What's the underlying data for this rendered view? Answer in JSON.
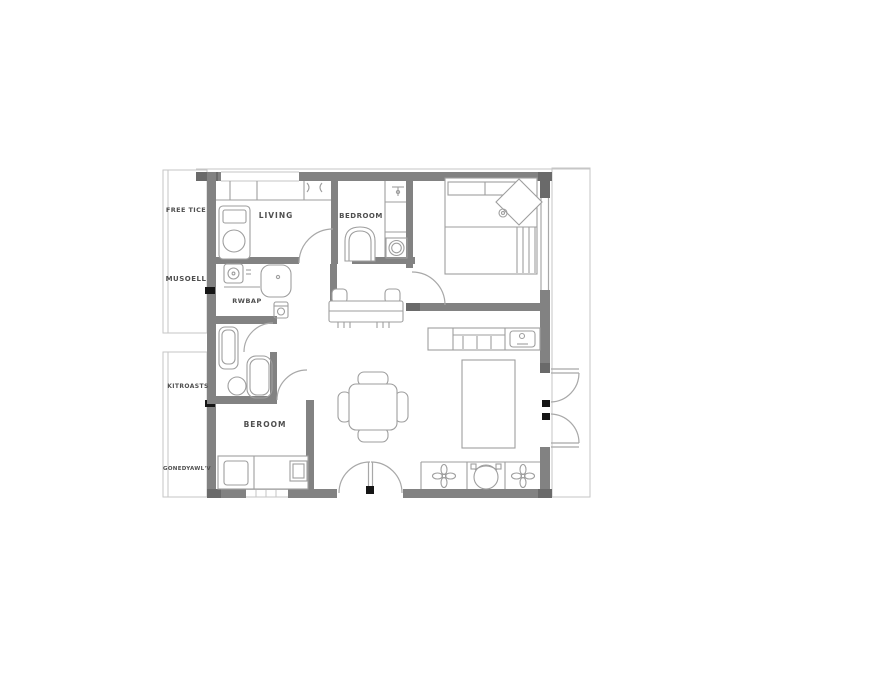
{
  "plan": {
    "colors": {
      "wall": "#828282",
      "wall_dark": "#6a6a6a",
      "line": "#a8a8a8",
      "furniture": "#9e9e9e",
      "label": "#4f4f4f",
      "accent_black": "#151515",
      "background": "#ffffff"
    },
    "rooms": {
      "living": {
        "label": "LIVING"
      },
      "bath_top": {
        "label": "BEDROOM"
      },
      "kitchen_laundry": {
        "label": "RWBAP"
      },
      "bedroom_bottom": {
        "label": "BEROOM"
      }
    },
    "side_labels": {
      "top_left_1": "FREE TICE",
      "top_left_2": "MUSOELL",
      "bottom_left_1": "KITROASTS",
      "bottom_left_2": "GONEDYAWL'V"
    }
  }
}
